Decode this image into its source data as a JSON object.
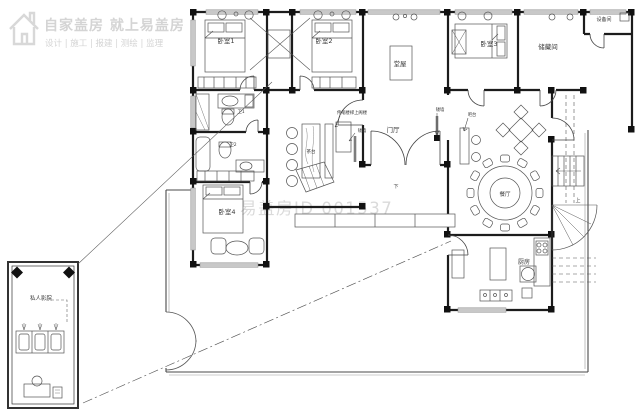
{
  "meta": {
    "type": "residential-floor-plan",
    "canvas_width": 640,
    "canvas_height": 412
  },
  "watermark": {
    "logo_title": "自家盖房 就上易盖房",
    "logo_subtitle": "设计 | 施工 | 报建 | 测绘 | 监理",
    "plan_id": "易盖房ID 001537"
  },
  "rooms": {
    "bedroom1": "卧室1",
    "bedroom2": "卧室2",
    "bedroom3": "卧室3",
    "bedroom4": "卧室4",
    "hall": "堂屋",
    "storage": "储藏间",
    "foyer": "门厅",
    "dining": "餐厅",
    "kitchen": "厨房",
    "equipment": "设备间",
    "bath1": "卫1",
    "bath2": "卫2",
    "tea_table": "茶台",
    "cinema": "私人影院"
  },
  "annotations": {
    "low_wall_left": "矮墙",
    "low_wall_right": "矮墙",
    "bar_counter": "吧台",
    "ladder_note": "伸缩楼梯上阁楼",
    "stair_up": "上",
    "stair_down": "下"
  },
  "colors": {
    "wall": "#1c1c1c",
    "yard_wall": "#4a4a4a",
    "window_fill": "#c8c8c8",
    "furniture_line": "#555555",
    "label": "#3a3a3a",
    "watermark": "#d4d4d4"
  }
}
